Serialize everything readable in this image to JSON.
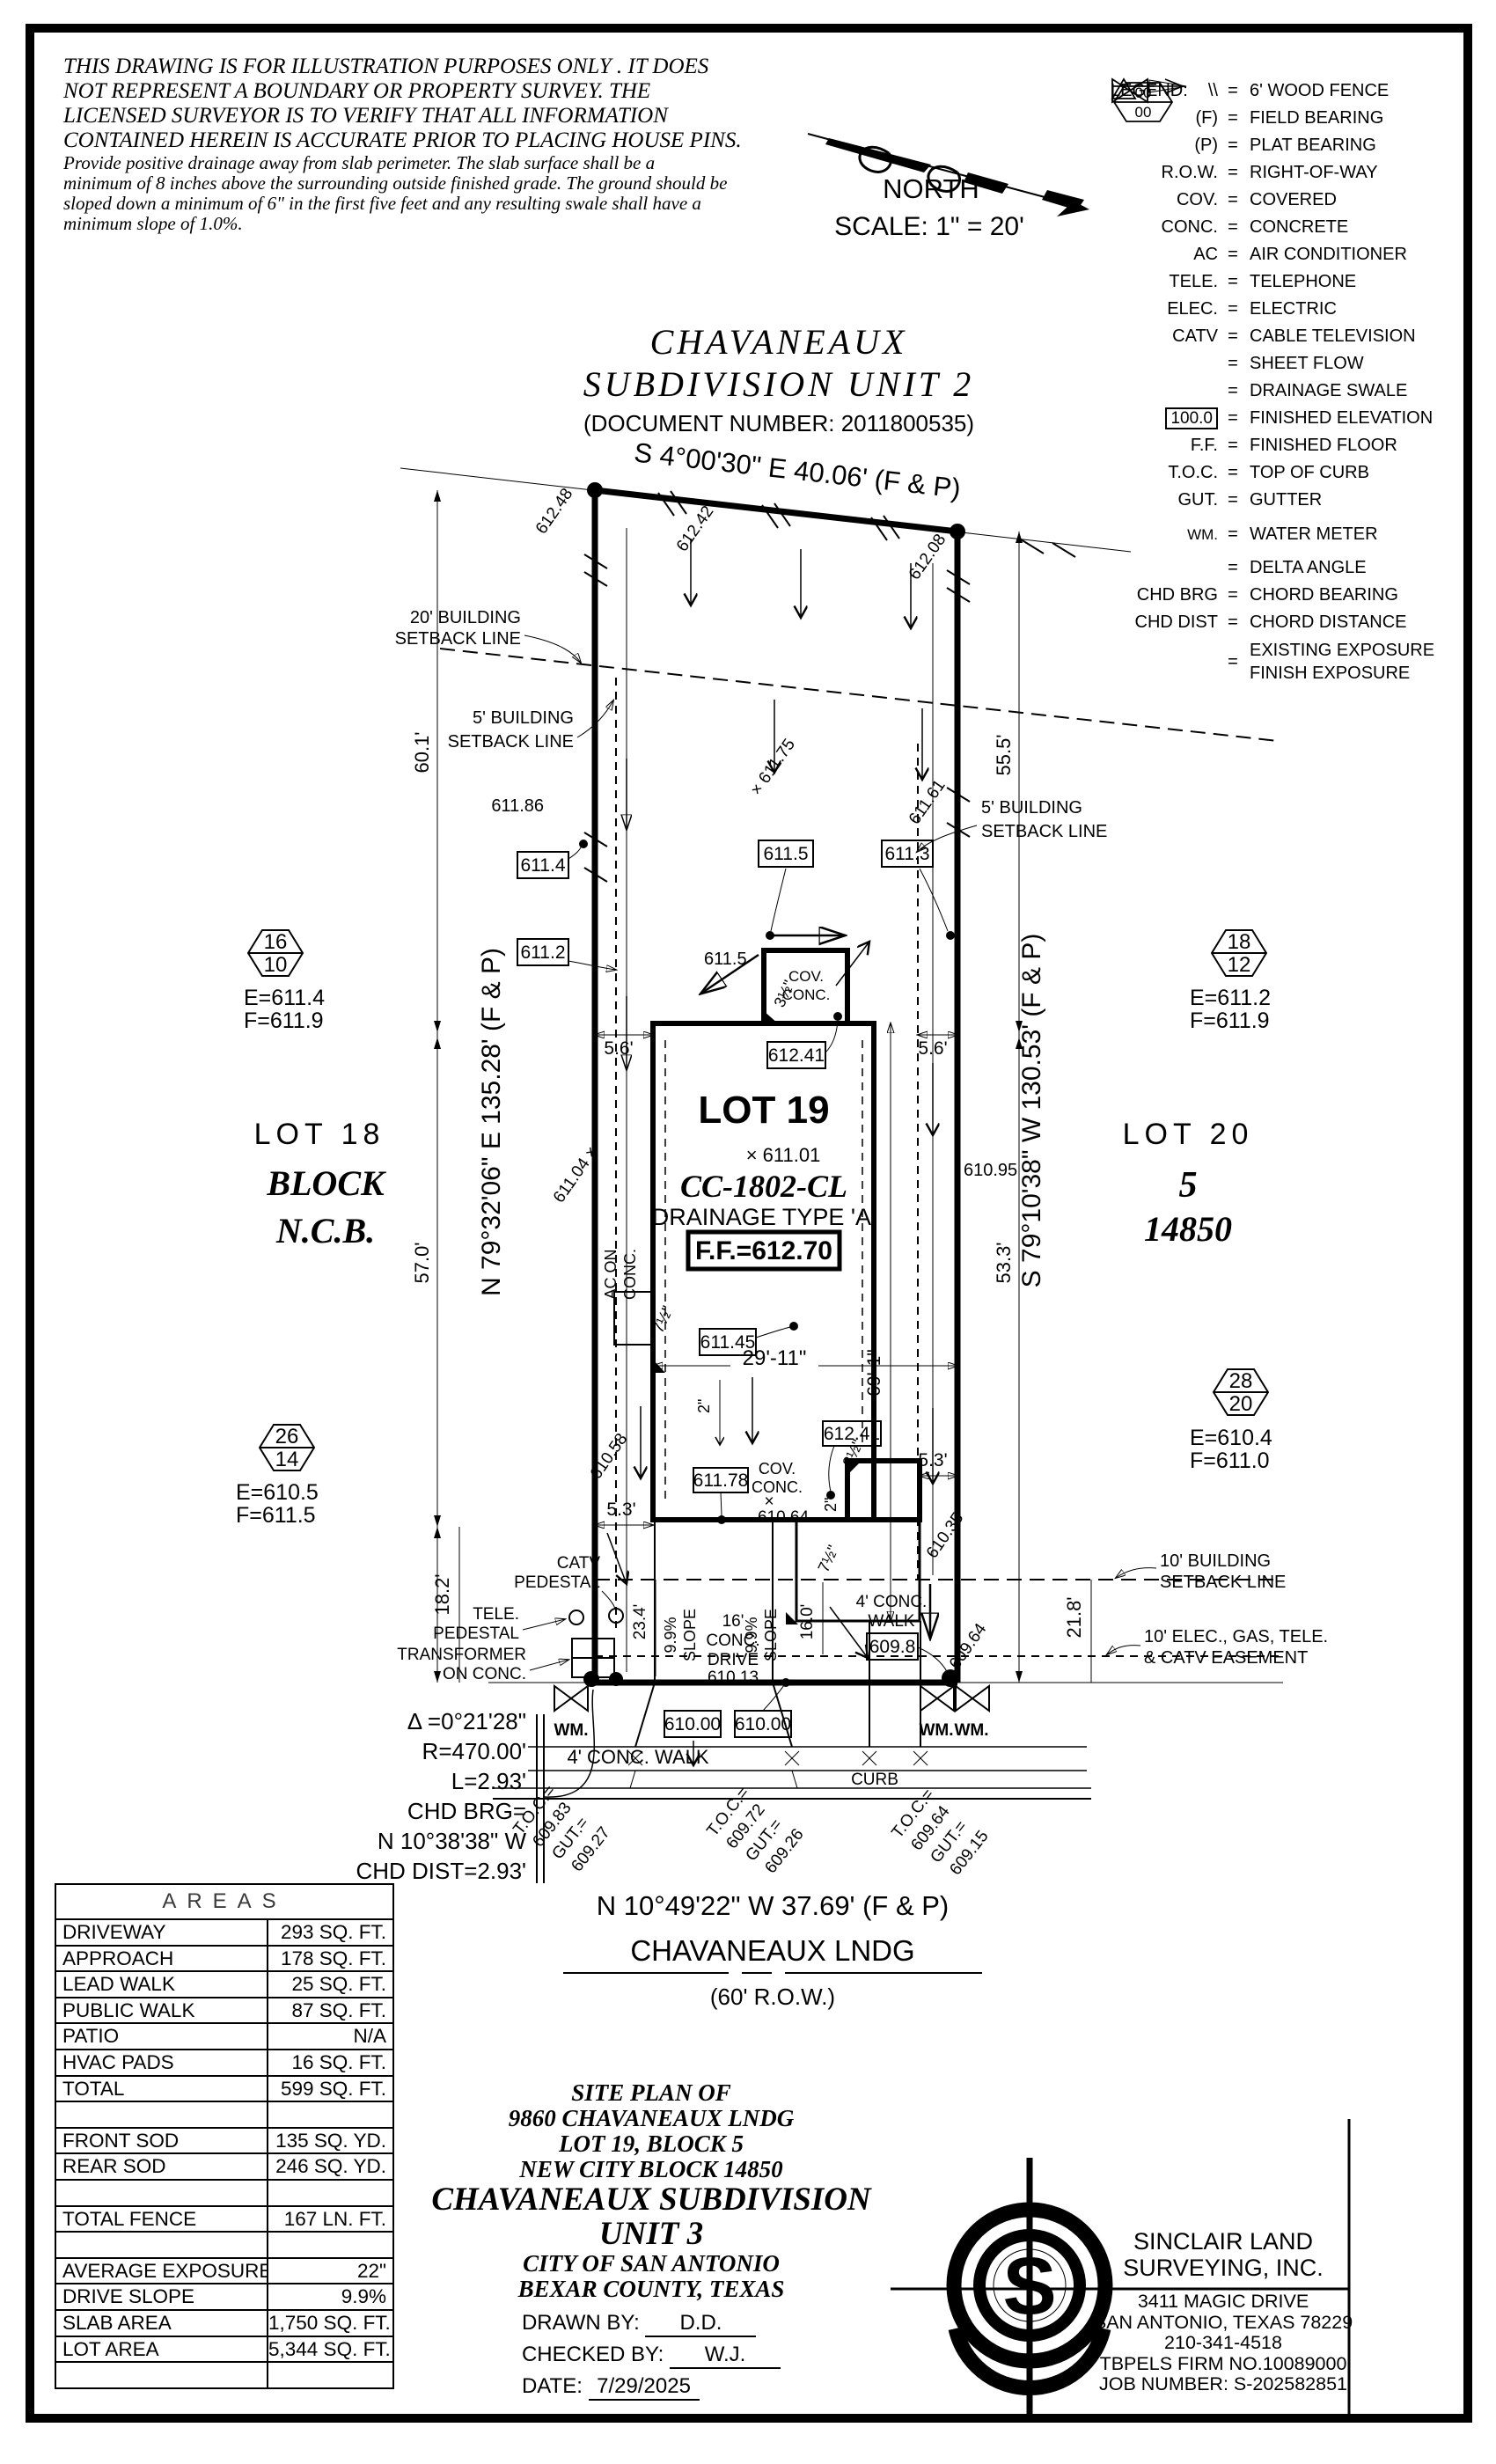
{
  "colors": {
    "accent_orange": "#C0512F",
    "title_gray": "#8A8A8A"
  },
  "disclaimer": {
    "caps": [
      "THIS DRAWING IS FOR ILLUSTRATION PURPOSES ONLY . IT DOES",
      "NOT REPRESENT A BOUNDARY OR PROPERTY SURVEY. THE",
      "LICENSED SURVEYOR IS TO VERIFY THAT ALL INFORMATION",
      "CONTAINED HEREIN IS ACCURATE PRIOR TO PLACING HOUSE PINS."
    ],
    "note": [
      "Provide positive drainage away from slab perimeter. The slab surface shall be a",
      "minimum of 8 inches above the surrounding outside finished grade. The ground should be",
      "sloped down a minimum of 6\" in the first five feet and any resulting swale shall have a",
      "minimum slope of 1.0%."
    ]
  },
  "compass": {
    "north": "NORTH",
    "scale": "SCALE: 1\" = 20'"
  },
  "legend": {
    "title": "LEGEND:",
    "eq": "=",
    "exposure_top": "00",
    "exposure_bottom": "00",
    "items": [
      {
        "sym": "\\\\",
        "desc": "6' WOOD FENCE"
      },
      {
        "sym": "(F)",
        "desc": "FIELD BEARING"
      },
      {
        "sym": "(P)",
        "desc": "PLAT BEARING"
      },
      {
        "sym": "R.O.W.",
        "desc": "RIGHT-OF-WAY"
      },
      {
        "sym": "COV.",
        "desc": "COVERED"
      },
      {
        "sym": "CONC.",
        "desc": "CONCRETE"
      },
      {
        "sym": "AC",
        "desc": "AIR CONDITIONER"
      },
      {
        "sym": "TELE.",
        "desc": "TELEPHONE"
      },
      {
        "sym": "ELEC.",
        "desc": "ELECTRIC"
      },
      {
        "sym": "CATV",
        "desc": "CABLE TELEVISION"
      },
      {
        "sym": "",
        "desc": "SHEET FLOW"
      },
      {
        "sym": "",
        "desc": "DRAINAGE SWALE"
      },
      {
        "sym": "100.0",
        "desc": "FINISHED ELEVATION"
      },
      {
        "sym": "F.F.",
        "desc": "FINISHED FLOOR"
      },
      {
        "sym": "T.O.C.",
        "desc": "TOP OF CURB"
      },
      {
        "sym": "GUT.",
        "desc": "GUTTER"
      },
      {
        "sym": "WM.",
        "desc": "WATER METER"
      },
      {
        "sym": "",
        "desc": "DELTA ANGLE"
      },
      {
        "sym": "CHD BRG",
        "desc": "CHORD BEARING"
      },
      {
        "sym": "CHD DIST",
        "desc": "CHORD DISTANCE"
      },
      {
        "sym": "",
        "desc": "EXISTING EXPOSURE",
        "desc2": "FINISH EXPOSURE"
      }
    ]
  },
  "subdivision": {
    "name1": "CHAVANEAUX",
    "name2": "SUBDIVISION UNIT 2",
    "doc": "(DOCUMENT NUMBER: 2011800535)"
  },
  "plot": {
    "rear_bearing": "S 4°00'30\" E 40.06' (F & P)",
    "left_bearing": "N 79°32'06\" E 135.28' (F & P)",
    "right_bearing": "S 79°10'38\" W 130.53' (F & P)",
    "front_bearing": "N 10°49'22\" W 37.69' (F & P)",
    "street_name": "CHAVANEAUX LNDG",
    "street_row": "(60' R.O.W.)",
    "lot19": "LOT 19",
    "lot19_spot": "× 611.01",
    "lot19_cc": "CC-1802-CL",
    "lot19_drainage": "DRAINAGE TYPE 'A'",
    "lot19_ff": "F.F.=612.70",
    "lot18": "LOT 18",
    "lot18_block": "BLOCK",
    "lot18_ncb": "N.C.B.",
    "lot20": "LOT 20",
    "lot20_block": "5",
    "lot20_ncb": "14850",
    "setback20": [
      "20' BUILDING",
      "SETBACK LINE"
    ],
    "setback5": [
      "5' BUILDING",
      "SETBACK LINE"
    ],
    "setback10": [
      "10' BUILDING",
      "SETBACK LINE"
    ],
    "easement": [
      "10' ELEC., GAS, TELE.",
      "& CATV EASEMENT"
    ],
    "catv": [
      "CATV",
      "PEDESTAL"
    ],
    "tele": [
      "TELE.",
      "PEDESTAL"
    ],
    "transformer": [
      "TRANSFORMER",
      "ON CONC."
    ],
    "ac": [
      "AC ON",
      "CONC."
    ],
    "wm": "WM.",
    "drive": [
      "16'",
      "CONC.",
      "DRIVE",
      "610.13"
    ],
    "walk": [
      "4' CONC.",
      "WALK"
    ],
    "walk2": "4' CONC. WALK",
    "curb": "CURB",
    "cov": [
      "COV.",
      "CONC."
    ],
    "slope": [
      "9.9%",
      "SLOPE"
    ],
    "curve": [
      "Δ =0°21'28\"",
      "R=470.00'",
      "L=2.93'",
      "CHD BRG=",
      "N 10°38'38\" W",
      "CHD DIST=2.93'"
    ],
    "toc": [
      {
        "l1": "T.O.C.=",
        "l2": "609.83",
        "l3": "GUT.=",
        "l4": "609.27"
      },
      {
        "l1": "T.O.C.=",
        "l2": "609.72",
        "l3": "GUT.=",
        "l4": "609.26"
      },
      {
        "l1": "T.O.C.=",
        "l2": "609.64",
        "l3": "GUT.=",
        "l4": "609.15"
      }
    ],
    "boxed": {
      "b6114": "611.4",
      "b6112": "611.2",
      "b6115": "611.5",
      "b6113": "611.3",
      "b61241a": "612.41",
      "b61241b": "612.41",
      "b61145": "611.45",
      "b61178": "611.78",
      "b6098": "609.8",
      "b61000a": "610.00",
      "b61000b": "610.00"
    },
    "spots": {
      "s61248": "612.48",
      "s61242": "612.42",
      "s61208": "612.08",
      "s61186": "611.86",
      "s61175": "× 611.75",
      "s61161": "611.61",
      "s6115": "611.5",
      "s61104": "611.04 ×",
      "s61095": "610.95",
      "s61058": "610.58",
      "s61064x": "×",
      "s61064": "610.64",
      "s61035": "610.35",
      "s60964": "609.64"
    },
    "dims": {
      "d56a": "5.6'",
      "d56b": "5.6'",
      "d691": "69'-1\"",
      "d2911": "29'-11\"",
      "d53a": "5.3'",
      "d53b": "5.3'",
      "d601": "60.1'",
      "d570": "57.0'",
      "d182": "18.2'",
      "d555": "55.5'",
      "d533": "53.3'",
      "d218": "21.8'",
      "d234": "23.4'",
      "d160": "16.0'",
      "d2a": "2\"",
      "d2b": "2\"",
      "d35a": "3½\"",
      "d35b": "3½\"",
      "d75a": "7½\"",
      "d75b": "7½\""
    }
  },
  "exposures": [
    {
      "top": "16",
      "bottom": "10",
      "e": "E=611.4",
      "f": "F=611.9"
    },
    {
      "top": "18",
      "bottom": "12",
      "e": "E=611.2",
      "f": "F=611.9"
    },
    {
      "top": "26",
      "bottom": "14",
      "e": "E=610.5",
      "f": "F=611.5"
    },
    {
      "top": "28",
      "bottom": "20",
      "e": "E=610.4",
      "f": "F=611.0"
    }
  ],
  "areas": {
    "title": "AREAS",
    "rows": [
      {
        "label": "DRIVEWAY",
        "value": "293 SQ. FT."
      },
      {
        "label": "APPROACH",
        "value": "178 SQ. FT."
      },
      {
        "label": "LEAD WALK",
        "value": "25 SQ. FT."
      },
      {
        "label": "PUBLIC WALK",
        "value": "87 SQ. FT."
      },
      {
        "label": "PATIO",
        "value": "N/A"
      },
      {
        "label": "HVAC PADS",
        "value": "16 SQ. FT."
      },
      {
        "label": "TOTAL",
        "value": "599 SQ. FT."
      },
      {
        "label": "",
        "value": ""
      },
      {
        "label": "FRONT SOD",
        "value": "135 SQ. YD."
      },
      {
        "label": "REAR SOD",
        "value": "246 SQ. YD."
      },
      {
        "label": "",
        "value": ""
      },
      {
        "label": "TOTAL FENCE",
        "value": "167 LN. FT."
      },
      {
        "label": "",
        "value": ""
      },
      {
        "label": "AVERAGE EXPOSURE",
        "value": "22\""
      },
      {
        "label": "DRIVE SLOPE",
        "value": "9.9%"
      },
      {
        "label": "SLAB AREA",
        "value": "1,750 SQ. FT."
      },
      {
        "label": "LOT AREA",
        "value": "5,344 SQ. FT."
      },
      {
        "label": "",
        "value": ""
      }
    ]
  },
  "title_block": {
    "l1": "SITE PLAN OF",
    "l2": "9860 CHAVANEAUX LNDG",
    "l3": "LOT 19, BLOCK 5",
    "l4": "NEW CITY BLOCK 14850",
    "l5": "CHAVANEAUX SUBDIVISION",
    "l6": "UNIT 3",
    "l7": "CITY OF SAN ANTONIO",
    "l8": "BEXAR COUNTY, TEXAS",
    "drawn_label": "DRAWN BY:",
    "drawn": "D.D.",
    "checked_label": "CHECKED BY:",
    "checked": "W.J.",
    "date_label": "DATE:",
    "date": "7/29/2025"
  },
  "firm": {
    "name1": "SINCLAIR LAND",
    "name2": "SURVEYING, INC.",
    "addr1": "3411 MAGIC DRIVE",
    "addr2": "SAN ANTONIO, TEXAS 78229",
    "phone": "210-341-4518",
    "firm_no": "TBPELS FIRM NO.10089000",
    "job": "JOB NUMBER: S-202582851",
    "logo_letter": "S"
  }
}
